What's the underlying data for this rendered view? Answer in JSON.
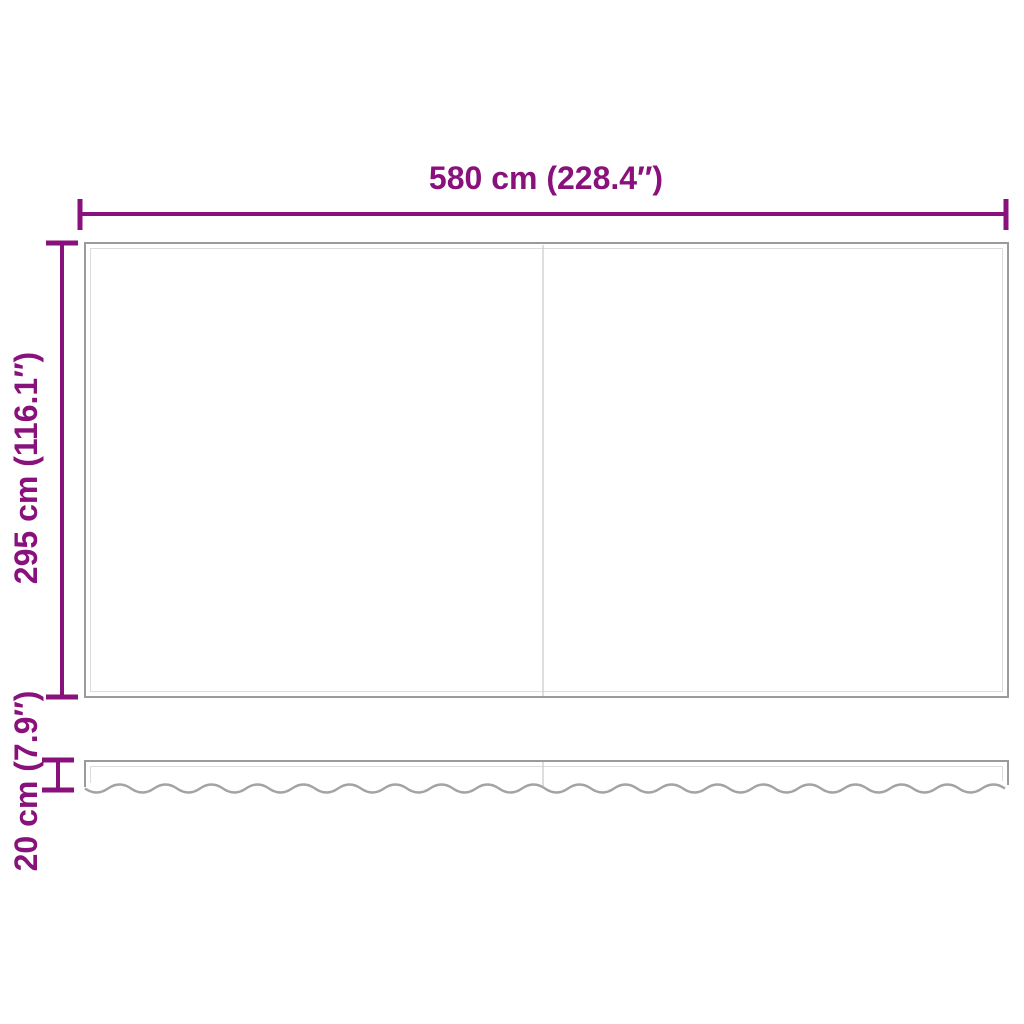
{
  "dimensions": {
    "width_label": "580 cm (228.4″)",
    "height_label": "295 cm (116.1″)",
    "valance_label": "20 cm (7.9″)"
  },
  "colors": {
    "accent": "#89117B",
    "outline": "#9B9B9B",
    "inner_line": "#DCDCDC",
    "seam_line": "#CFCFCF",
    "wave_line": "#A3A3A3",
    "background": "#FFFFFF"
  }
}
